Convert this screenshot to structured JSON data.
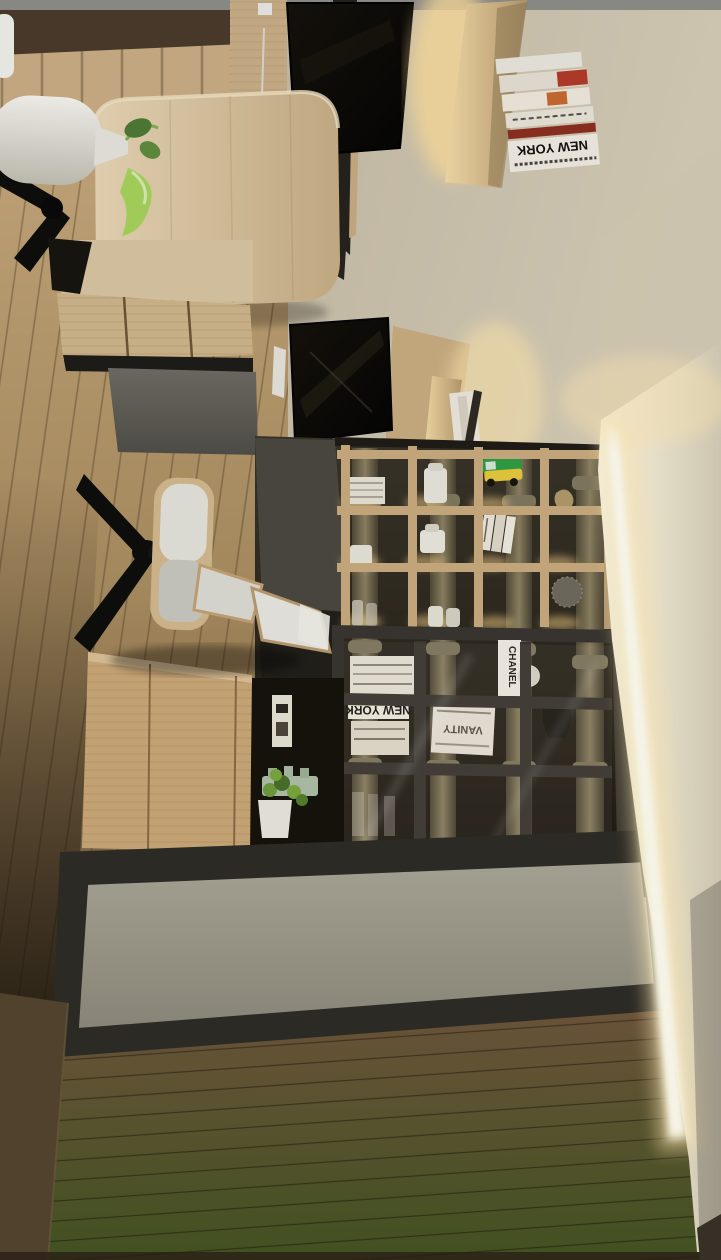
{
  "scene": {
    "type": "3d-interior-render",
    "description": "Rotated architectural render of a modern home study: wood desks with monitors, floating book shelves, gridded display bookcase with glass doors and classical column backdrop, lounge chair, LED cove lighting"
  },
  "labels": {
    "books": {
      "shelf_stack_title": "NEW YORK",
      "cabinet_stack_title": "NEW YORK",
      "chanel_spine": "CHANEL",
      "vanity_spine": "VANITY"
    }
  },
  "colors": {
    "top_band": "#8d8d8a",
    "wall_beige": "#c9c0aa",
    "wall_white": "#f7f1de",
    "led_warm": "#ffe9b4",
    "wood_light": "#cdb088",
    "wood_floor": "#b5976b",
    "wood_floor_dark": "#5e4a35",
    "walnut_desk": "#4b3b2b",
    "monitor_black": "#0b0a08",
    "shelf_background": "#2a251d",
    "column_olive": "#877d62",
    "frame_dark": "#35322c",
    "gray_panel": "#a09c8e",
    "vase_white": "#efede6",
    "leather_white": "#dddcd4",
    "plant_green": "#79a83f",
    "toy_green": "#2f9e44",
    "toy_yellow": "#e7c93d",
    "book_white": "#eae6de",
    "book_red": "#a93827",
    "wall_brown": "#55452f"
  }
}
